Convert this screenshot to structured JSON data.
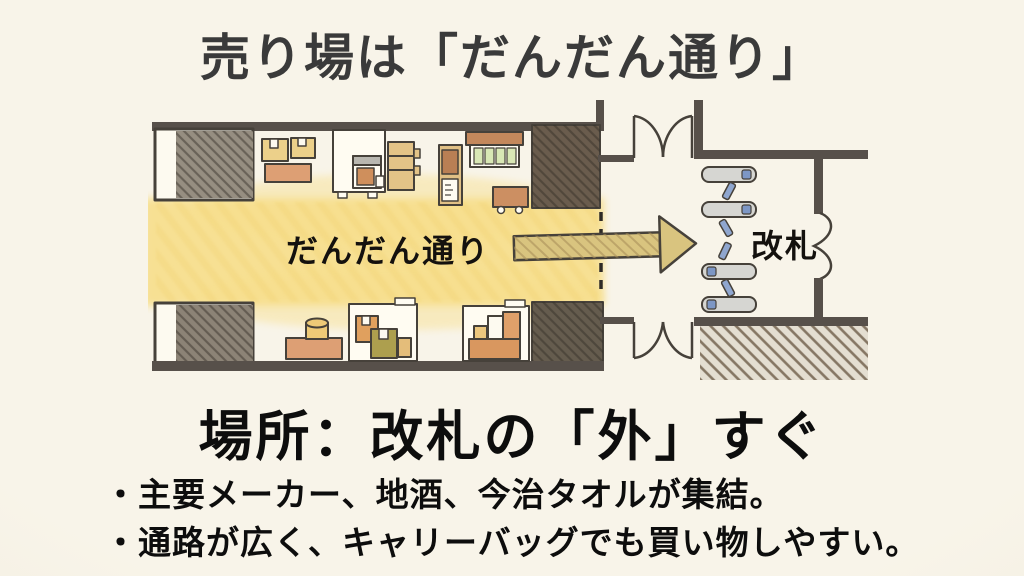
{
  "slide": {
    "title": "売り場は「だんだん通り」",
    "subtitle": "場所：改札の「外」すぐ",
    "bullets": [
      "・主要メーカー、地酒、今治タオルが集結。",
      "・通路が広く、キャリーバッグでも買い物しやすい。"
    ]
  },
  "map": {
    "street_label": "だんだん通り",
    "gate_label": "改札",
    "gate_machine_count": 4
  },
  "colors": {
    "background": "#f6f1e4",
    "title_text": "#3a3a3a",
    "body_text": "#0d0d0d",
    "map_ink": "#46413a",
    "wall_dark": "#57504a",
    "highlight_yellow": "#f7df8c",
    "arrow_fill": "#d9c47f",
    "gate_machine_gray": "#d6d6d2",
    "gate_accent_blue": "#7d97c5"
  }
}
